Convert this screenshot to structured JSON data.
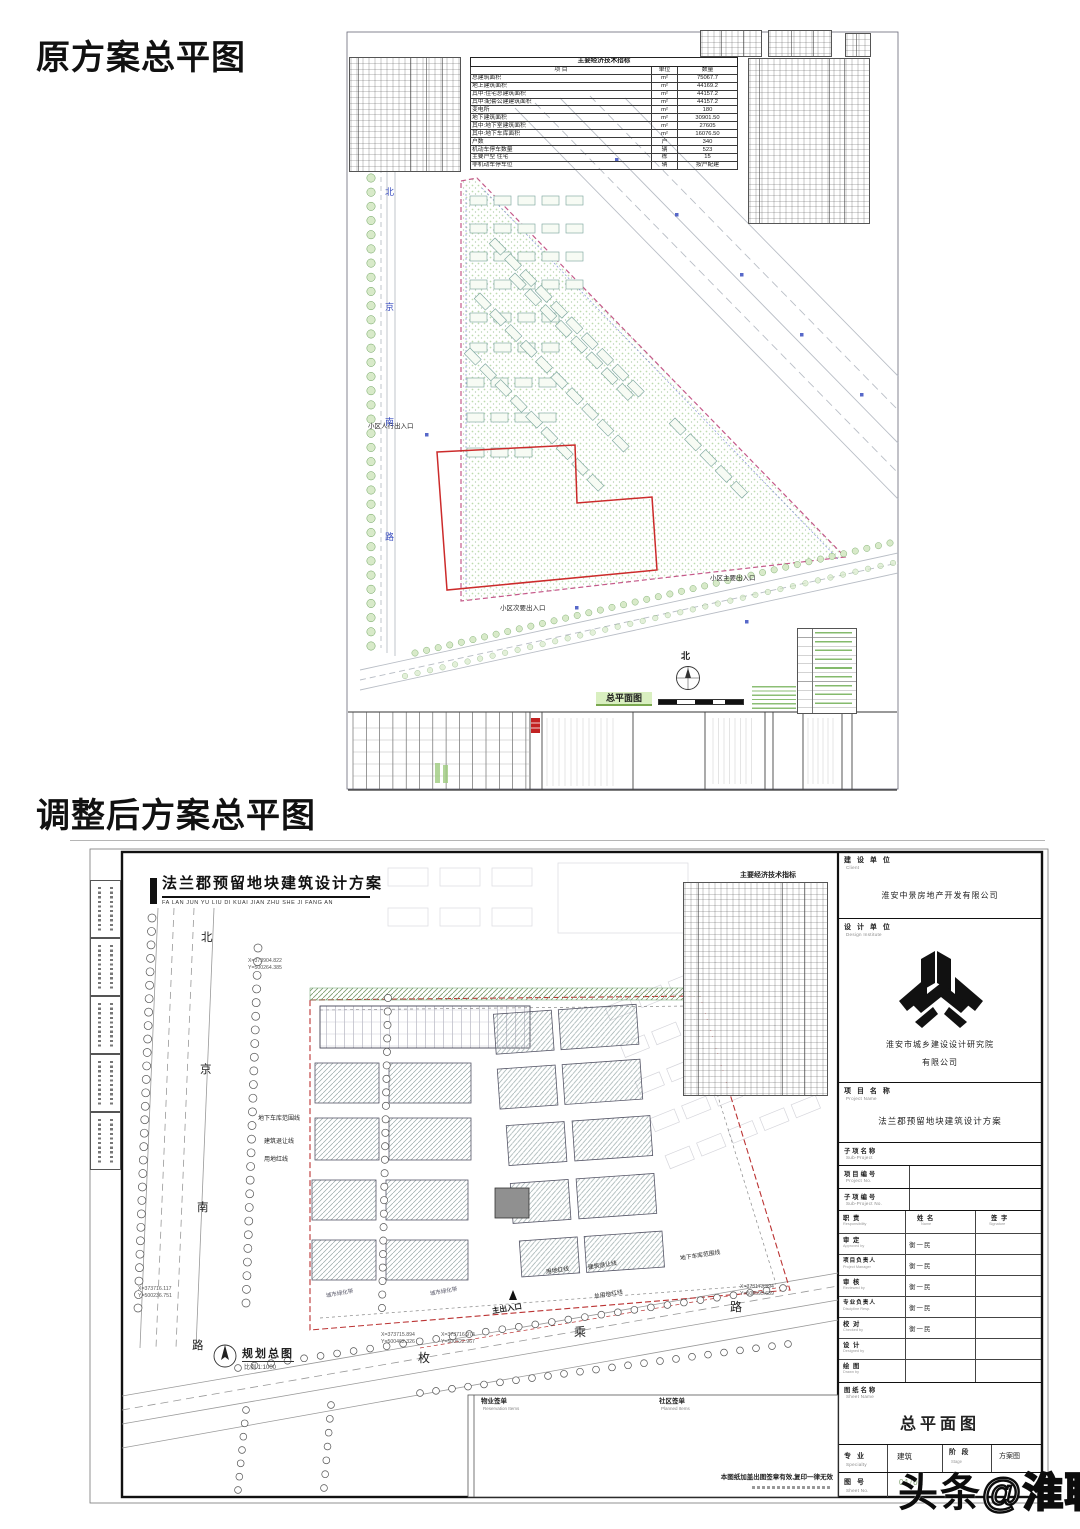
{
  "page": {
    "section1_title": "原方案总平图",
    "section2_title": "调整后方案总平图",
    "watermark_solid": "头条",
    "watermark_outline": "@淮聊"
  },
  "colors": {
    "red_line": "#cc2b2b",
    "pink_boundary": "#c55a8a",
    "tree_green": "#69a05a",
    "blue_note": "#3a4ec0",
    "stamp_green": "#8fbf6f",
    "frame_dark": "#111111"
  },
  "d1": {
    "econ": {
      "title": "主要经济技术指标",
      "cols": [
        "项 目",
        "单位",
        "数量"
      ],
      "rows": [
        [
          "总建筑面积",
          "m²",
          "75067.7"
        ],
        [
          "地上建筑面积",
          "m²",
          "44169.2"
        ],
        [
          "其中:住宅总建筑面积",
          "m²",
          "44157.2"
        ],
        [
          "其中:配套公建建筑面积",
          "m²",
          "44157.2"
        ],
        [
          "变电所",
          "m²",
          "180"
        ],
        [
          "地下建筑面积",
          "m²",
          "30901.50"
        ],
        [
          "其中:地下室建筑面积",
          "m²",
          "27605"
        ],
        [
          "其中:地下车库面积",
          "m²",
          "16076.50"
        ],
        [
          "户数",
          "户",
          "340"
        ],
        [
          "机动车停车数量",
          "辆",
          "523"
        ],
        [
          "主要户型 住宅",
          "栋",
          "15"
        ],
        [
          "非机动车停车位",
          "辆",
          "按户配建"
        ]
      ]
    },
    "labels": {
      "pedestrian": "小区人行出入口",
      "main": "小区主要出入口",
      "secondary": "小区次要出入口",
      "north": "北",
      "caption": "总平面图"
    },
    "side_chars": [
      "北",
      "京",
      "南",
      "路"
    ]
  },
  "d2": {
    "title": "法兰郡预留地块建筑设计方案",
    "pinyin": "FA LAN JUN YU LIU DI KUAI JIAN ZHU SHE JI FANG AN",
    "econ_title": "主要经济技术指标",
    "road_v": [
      "北",
      "京",
      "南",
      "路"
    ],
    "road_h": [
      "枚",
      "乘",
      "路"
    ],
    "labels": {
      "garage": "地下车库范围线",
      "setback": "建筑退让线",
      "redline": "用地红线",
      "garage2": "地下车库范围线",
      "setback2": "建筑退让线",
      "redline2": "用地红线",
      "total_redline": "总用地红线",
      "greenbelt": "城市绿化带",
      "main_entrance": "主出入口",
      "plan_caption": "规划总图",
      "plan_scale": "比例 1:1000"
    },
    "coords": [
      {
        "x": "X=373904.822",
        "y": "Y=500264.385"
      },
      {
        "x": "X=373716.117",
        "y": "Y=500236.751"
      },
      {
        "x": "X=373715.894",
        "y": "Y=500462.326"
      },
      {
        "x": "X=373716.974",
        "y": "Y=500522.967"
      },
      {
        "x": "X=373173.394",
        "y": "Y=500595.639"
      }
    ],
    "box": {
      "left_cn": "物业签单",
      "left_en": "Reservation Items",
      "right_cn": "社区签单",
      "right_en": "Planned Items",
      "note": "本图纸加盖出图签章有效,复印一律无效"
    },
    "titleblock": {
      "client_lab": "建 设 单 位",
      "client_en": "Client",
      "client": "淮安中景房地产开发有限公司",
      "designer_lab": "设 计 单 位",
      "designer_en": "Design Institute",
      "designer1": "淮安市城乡建设设计研究院",
      "designer2": "有限公司",
      "project_lab": "项 目 名 称",
      "project_en": "Project Name",
      "project": "法兰郡预留地块建筑设计方案",
      "sub_lab": "子项名称",
      "sub_en": "Sub-Project",
      "projno_lab": "项目编号",
      "projno_en": "Project No.",
      "subno_lab": "子项编号",
      "subno_en": "Sub-Project No.",
      "resp": "职 责",
      "resp_en": "Responsibility",
      "name": "姓 名",
      "name_en": "Name",
      "sign": "签 字",
      "sign_en": "Signature",
      "rows": [
        {
          "cn": "审 定",
          "en": "Approved by",
          "name": "衡一民"
        },
        {
          "cn": "项目负责人",
          "en": "Project Manager",
          "name": "衡一民"
        },
        {
          "cn": "审 核",
          "en": "Reviewed by",
          "name": "衡一民"
        },
        {
          "cn": "专业负责人",
          "en": "Discipline Resp.",
          "name": "衡一民"
        },
        {
          "cn": "校 对",
          "en": "Checked by",
          "name": "衡一民"
        },
        {
          "cn": "设 计",
          "en": "Designed by",
          "name": ""
        },
        {
          "cn": "绘 图",
          "en": "Drawn by",
          "name": ""
        }
      ],
      "sheet_lab": "图纸名称",
      "sheet_en": "Sheet Name",
      "sheet": "总平面图",
      "major_lab": "专 业",
      "major_en": "Specialty",
      "major_val": "建筑",
      "stage_lab": "阶 段",
      "stage_en": "Stage",
      "stage_val": "方案图",
      "no_lab": "图 号",
      "no_en": "Sheet No.",
      "no_val": "01/01"
    }
  }
}
